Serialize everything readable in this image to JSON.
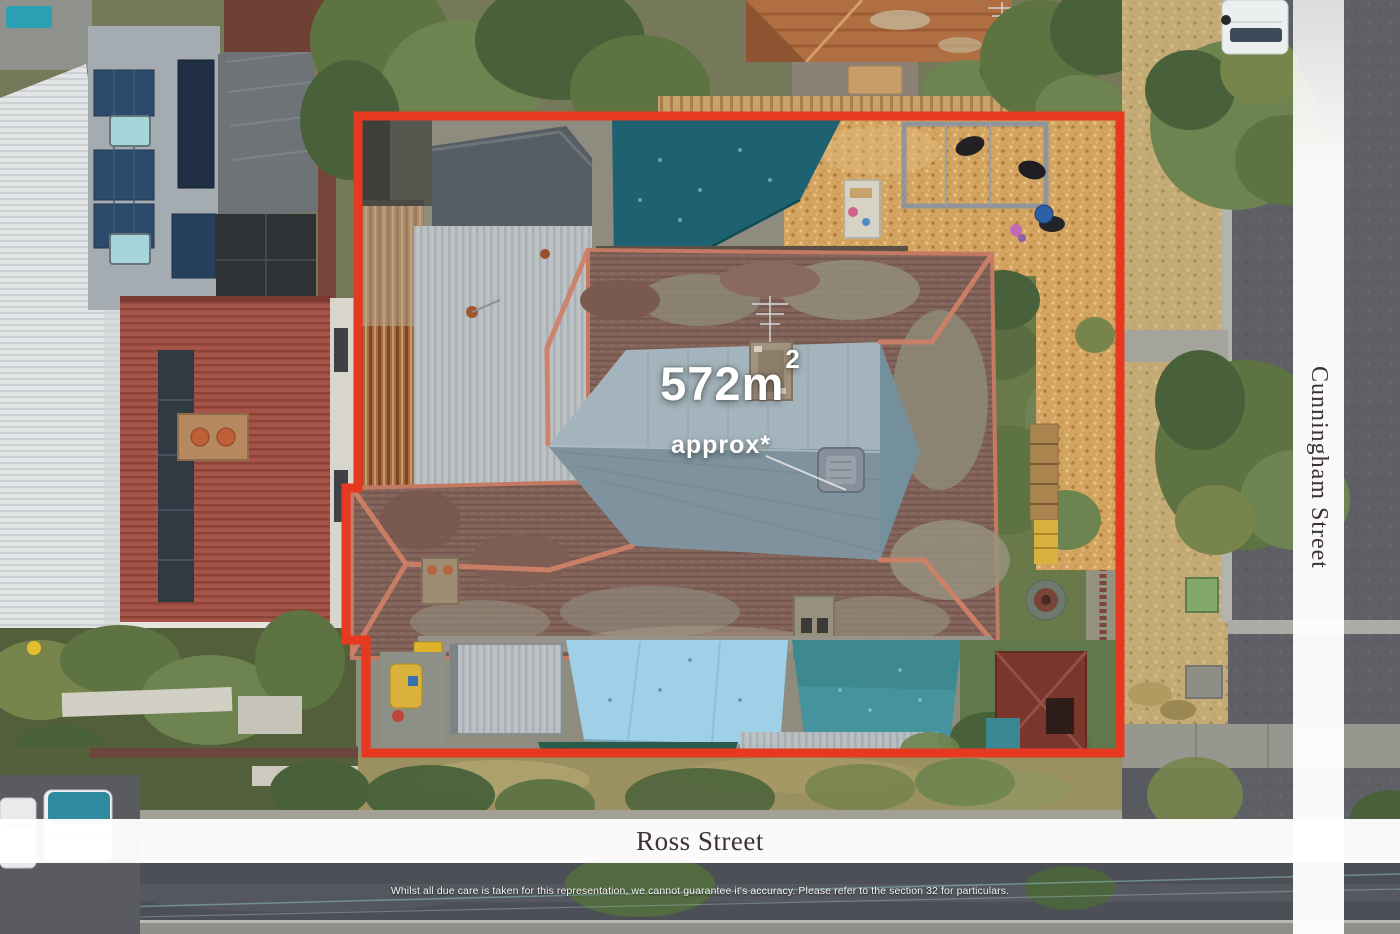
{
  "overlay": {
    "area": {
      "text": "572m",
      "superscript": "2",
      "qualifier": "approx*"
    },
    "streets": {
      "bottom": "Ross Street",
      "right": "Cunningham Street"
    },
    "disclaimer": "Whilst all due care is taken for this representation, we cannot guarantee it's accuracy. Please refer to the section 32 for particulars.",
    "colors": {
      "boundary": "#e6391f",
      "street_band": "#ffffff",
      "street_text": "#3d3236",
      "area_text": "#ffffff"
    }
  }
}
